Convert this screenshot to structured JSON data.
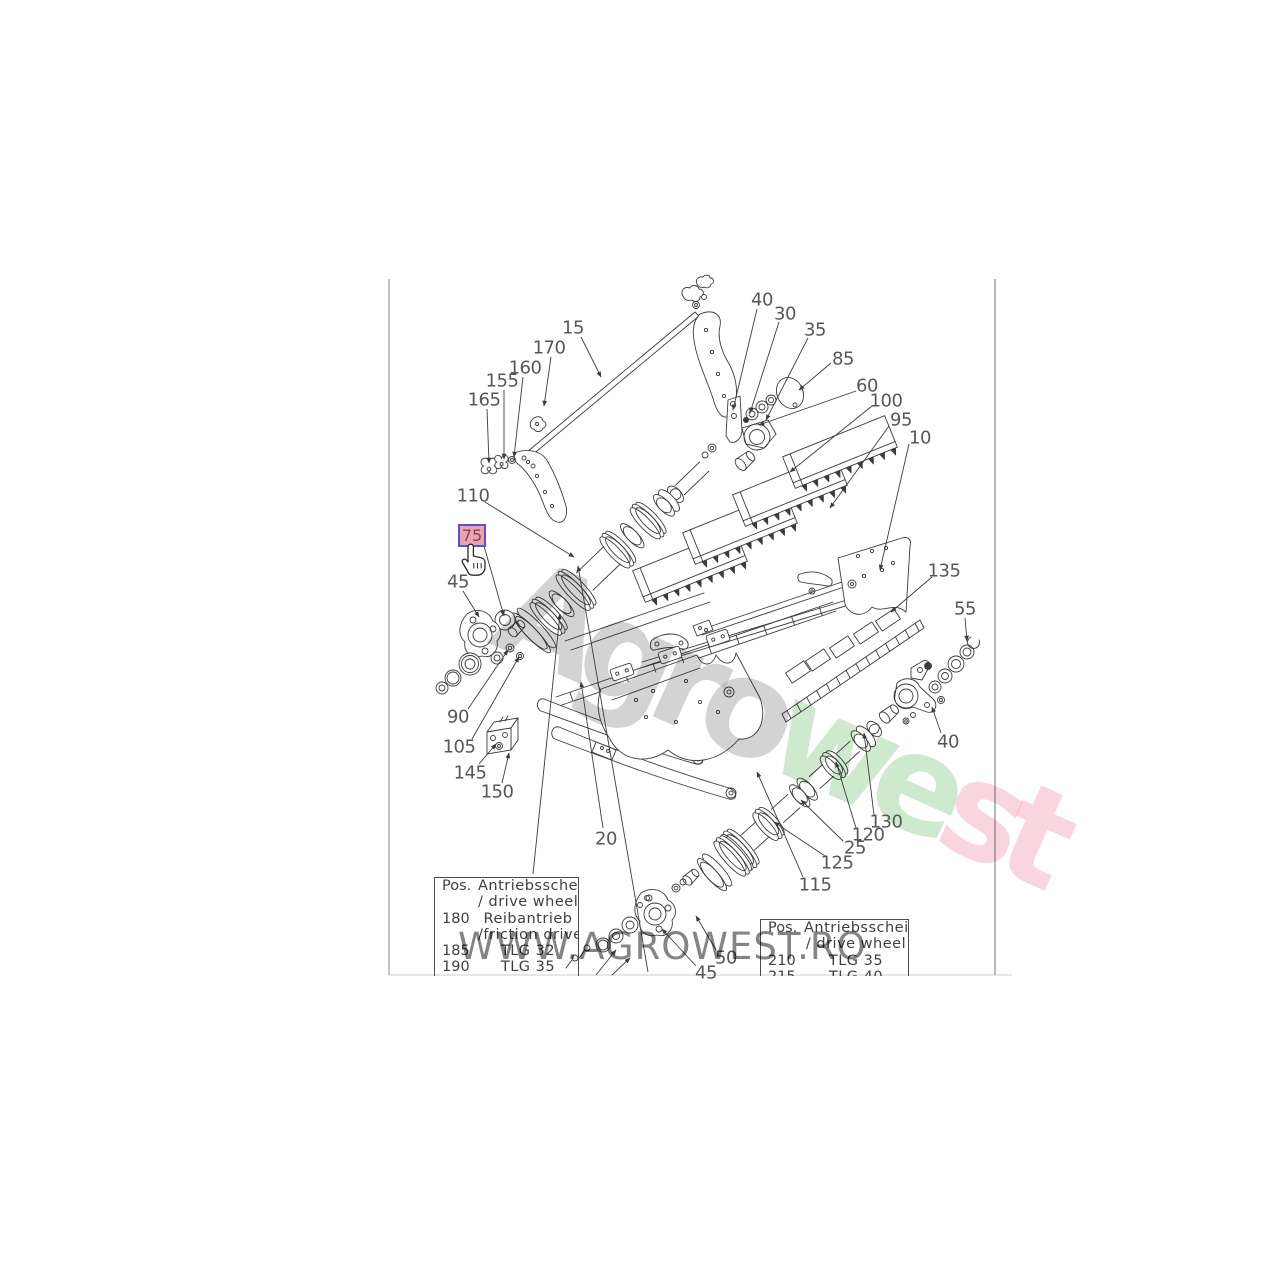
{
  "diagram": {
    "line_color": "#3c3c3c",
    "label_color": "#575757",
    "border_color": "#a8a8a8",
    "labels": [
      {
        "text": "15",
        "x": 573,
        "y": 327,
        "sx": 581,
        "sy": 337,
        "ax": 601,
        "ay": 377
      },
      {
        "text": "170",
        "x": 549,
        "y": 347,
        "sx": 551,
        "sy": 357,
        "ax": 544,
        "ay": 406
      },
      {
        "text": "160",
        "x": 525,
        "y": 367,
        "sx": 523,
        "sy": 377,
        "ax": 514,
        "ay": 457
      },
      {
        "text": "155",
        "x": 502,
        "y": 380,
        "sx": 504,
        "sy": 390,
        "ax": 504,
        "ay": 459
      },
      {
        "text": "165",
        "x": 484,
        "y": 399,
        "sx": 487,
        "sy": 409,
        "ax": 489,
        "ay": 463
      },
      {
        "text": "40",
        "x": 762,
        "y": 299,
        "sx": 757,
        "sy": 309,
        "ax": 733,
        "ay": 410
      },
      {
        "text": "30",
        "x": 785,
        "y": 313,
        "sx": 779,
        "sy": 322,
        "ax": 750,
        "ay": 413
      },
      {
        "text": "35",
        "x": 815,
        "y": 329,
        "sx": 808,
        "sy": 338,
        "ax": 766,
        "ay": 420
      },
      {
        "text": "85",
        "x": 843,
        "y": 358,
        "sx": 831,
        "sy": 363,
        "ax": 799,
        "ay": 390
      },
      {
        "text": "60",
        "x": 867,
        "y": 385,
        "sx": 856,
        "sy": 391,
        "ax": 759,
        "ay": 425
      },
      {
        "text": "100",
        "x": 886,
        "y": 400,
        "sx": 872,
        "sy": 406,
        "ax": 790,
        "ay": 472
      },
      {
        "text": "95",
        "x": 901,
        "y": 419,
        "sx": 889,
        "sy": 426,
        "ax": 830,
        "ay": 508
      },
      {
        "text": "10",
        "x": 920,
        "y": 437,
        "sx": 909,
        "sy": 444,
        "ax": 880,
        "ay": 570
      },
      {
        "text": "110",
        "x": 473,
        "y": 495,
        "sx": 485,
        "sy": 502,
        "ax": 574,
        "ay": 557
      },
      {
        "text": "45",
        "x": 458,
        "y": 581,
        "sx": 463,
        "sy": 591,
        "ax": 479,
        "ay": 617
      },
      {
        "text": "90",
        "x": 458,
        "y": 716,
        "sx": 468,
        "sy": 709,
        "ax": 508,
        "ay": 650
      },
      {
        "text": "105",
        "x": 459,
        "y": 746,
        "sx": 472,
        "sy": 739,
        "ax": 519,
        "ay": 657
      },
      {
        "text": "145",
        "x": 470,
        "y": 772,
        "sx": 479,
        "sy": 764,
        "ax": 496,
        "ay": 744
      },
      {
        "text": "150",
        "x": 497,
        "y": 791,
        "sx": 502,
        "sy": 783,
        "ax": 509,
        "ay": 753
      },
      {
        "text": "20",
        "x": 606,
        "y": 838,
        "sx": 603,
        "sy": 828,
        "ax": 581,
        "ay": 682
      },
      {
        "text": "135",
        "x": 944,
        "y": 570,
        "sx": 932,
        "sy": 577,
        "ax": 891,
        "ay": 612
      },
      {
        "text": "55",
        "x": 965,
        "y": 608,
        "sx": 965,
        "sy": 618,
        "ax": 967,
        "ay": 641
      },
      {
        "text": "40",
        "x": 948,
        "y": 741,
        "sx": 941,
        "sy": 733,
        "ax": 932,
        "ay": 707
      },
      {
        "text": "130",
        "x": 886,
        "y": 821,
        "sx": 874,
        "sy": 815,
        "ax": 864,
        "ay": 733
      },
      {
        "text": "120",
        "x": 868,
        "y": 834,
        "sx": 856,
        "sy": 828,
        "ax": 836,
        "ay": 762
      },
      {
        "text": "25",
        "x": 855,
        "y": 847,
        "sx": 843,
        "sy": 841,
        "ax": 801,
        "ay": 800
      },
      {
        "text": "125",
        "x": 837,
        "y": 862,
        "sx": 825,
        "sy": 856,
        "ax": 774,
        "ay": 822
      },
      {
        "text": "115",
        "x": 815,
        "y": 884,
        "sx": 803,
        "sy": 877,
        "ax": 757,
        "ay": 772
      },
      {
        "text": "50",
        "x": 726,
        "y": 957,
        "sx": 716,
        "sy": 950,
        "ax": 696,
        "ay": 916
      },
      {
        "text": "45",
        "x": 706,
        "y": 972,
        "sx": 696,
        "sy": 966,
        "ax": 662,
        "ay": 929
      }
    ],
    "truncated_leaders": [
      {
        "x1": 533,
        "y1": 874,
        "x2": 560,
        "y2": 614
      },
      {
        "x1": 648,
        "y1": 972,
        "x2": 578,
        "y2": 566
      },
      {
        "x1": 596,
        "y1": 975,
        "x2": 616,
        "y2": 950
      },
      {
        "x1": 612,
        "y1": 975,
        "x2": 630,
        "y2": 958
      }
    ]
  },
  "highlight": {
    "label": "75",
    "bg": "#e9a4b0",
    "border": "#5b50cb",
    "text_color": "#8e4350",
    "leader": {
      "sx": 484,
      "sy": 546,
      "ax": 504,
      "ay": 616
    }
  },
  "tables": {
    "left": {
      "rows": [
        {
          "pos": "Pos.",
          "desc": "Antriebsscheibe"
        },
        {
          "pos": "",
          "desc": "/ drive  wheel"
        },
        {
          "pos": "180",
          "desc": "Reibantrieb"
        },
        {
          "pos": "",
          "desc": "/friction drive"
        },
        {
          "pos": "185",
          "desc": "TLG 32"
        },
        {
          "pos": "190",
          "desc": "TLG 35"
        }
      ]
    },
    "right": {
      "rows": [
        {
          "pos": "Pos.",
          "desc": "Antriebsscheibe"
        },
        {
          "pos": "",
          "desc": "/ drive  wheel"
        },
        {
          "pos": "210",
          "desc": "TLG 35"
        },
        {
          "pos": "215",
          "desc": "TLG 40"
        }
      ]
    }
  },
  "watermarks": {
    "horizontal": {
      "text": "WWW.AGROWEST.RO",
      "color": "#848484"
    },
    "diagonal": {
      "segments": [
        {
          "text": "Agro",
          "color": "#a8a8a8"
        },
        {
          "text": "we",
          "color": "#9fd49f"
        },
        {
          "text": "st",
          "color": "#f3aec0"
        }
      ]
    }
  }
}
